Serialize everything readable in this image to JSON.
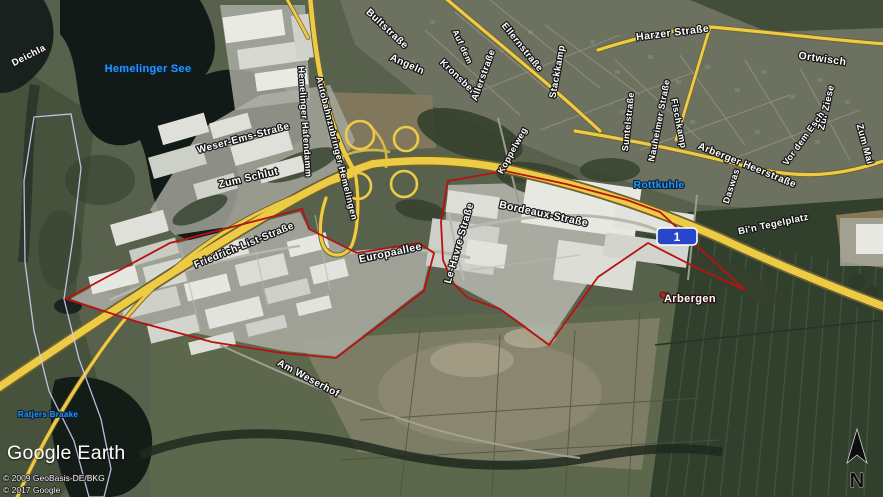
{
  "branding": {
    "logo": "Google Earth",
    "copyright1": "© 2009 GeoBasis-DE/BKG",
    "copyright2": "© 2017 Google"
  },
  "compass": {
    "north_label": "N"
  },
  "highway_shield": {
    "number": "1"
  },
  "place_labels": [
    {
      "text": "Arbergen"
    }
  ],
  "water_labels": [
    {
      "text": "Hemelinger See"
    },
    {
      "text": "Rottkuhle"
    },
    {
      "text": "Ratjers Braake"
    }
  ],
  "road_labels": [
    {
      "text": "Deichla"
    },
    {
      "text": "Weser-Ems-Straße"
    },
    {
      "text": "Zum Schlut"
    },
    {
      "text": "Hemelinger Hafendamm"
    },
    {
      "text": "Autobahnzubringer Hemelingen"
    },
    {
      "text": "Bultstraße"
    },
    {
      "text": "Angeln"
    },
    {
      "text": "Auf dem"
    },
    {
      "text": "Kronsberg"
    },
    {
      "text": "Allerstraße"
    },
    {
      "text": "Ellernstraße"
    },
    {
      "text": "Stackkamp"
    },
    {
      "text": "Harzer Straße"
    },
    {
      "text": "Ortwisch"
    },
    {
      "text": "Suntelstraße"
    },
    {
      "text": "Nauheimer Straße"
    },
    {
      "text": "Fischkamp"
    },
    {
      "text": "Zur Ziese"
    },
    {
      "text": "Vor dem Esch"
    },
    {
      "text": "Zum Mai"
    },
    {
      "text": "Koppelweg"
    },
    {
      "text": "Arberger Heerstraße"
    },
    {
      "text": "Daswas"
    },
    {
      "text": "Bi'n Tegelplatz"
    },
    {
      "text": "Bordeaux-Straße"
    },
    {
      "text": "Le-Havre-Straße"
    },
    {
      "text": "Europaallee"
    },
    {
      "text": "Friedrich-List-Straße"
    },
    {
      "text": "Am Weserhof"
    }
  ],
  "colors": {
    "road_yellow": "#eecb45",
    "road_casing": "#6e6130",
    "boundary_red": "#b81111",
    "boundary_lavender": "#cdcdf6",
    "shield_blue": "#2746c9",
    "water_label_blue": "#2196ff"
  }
}
